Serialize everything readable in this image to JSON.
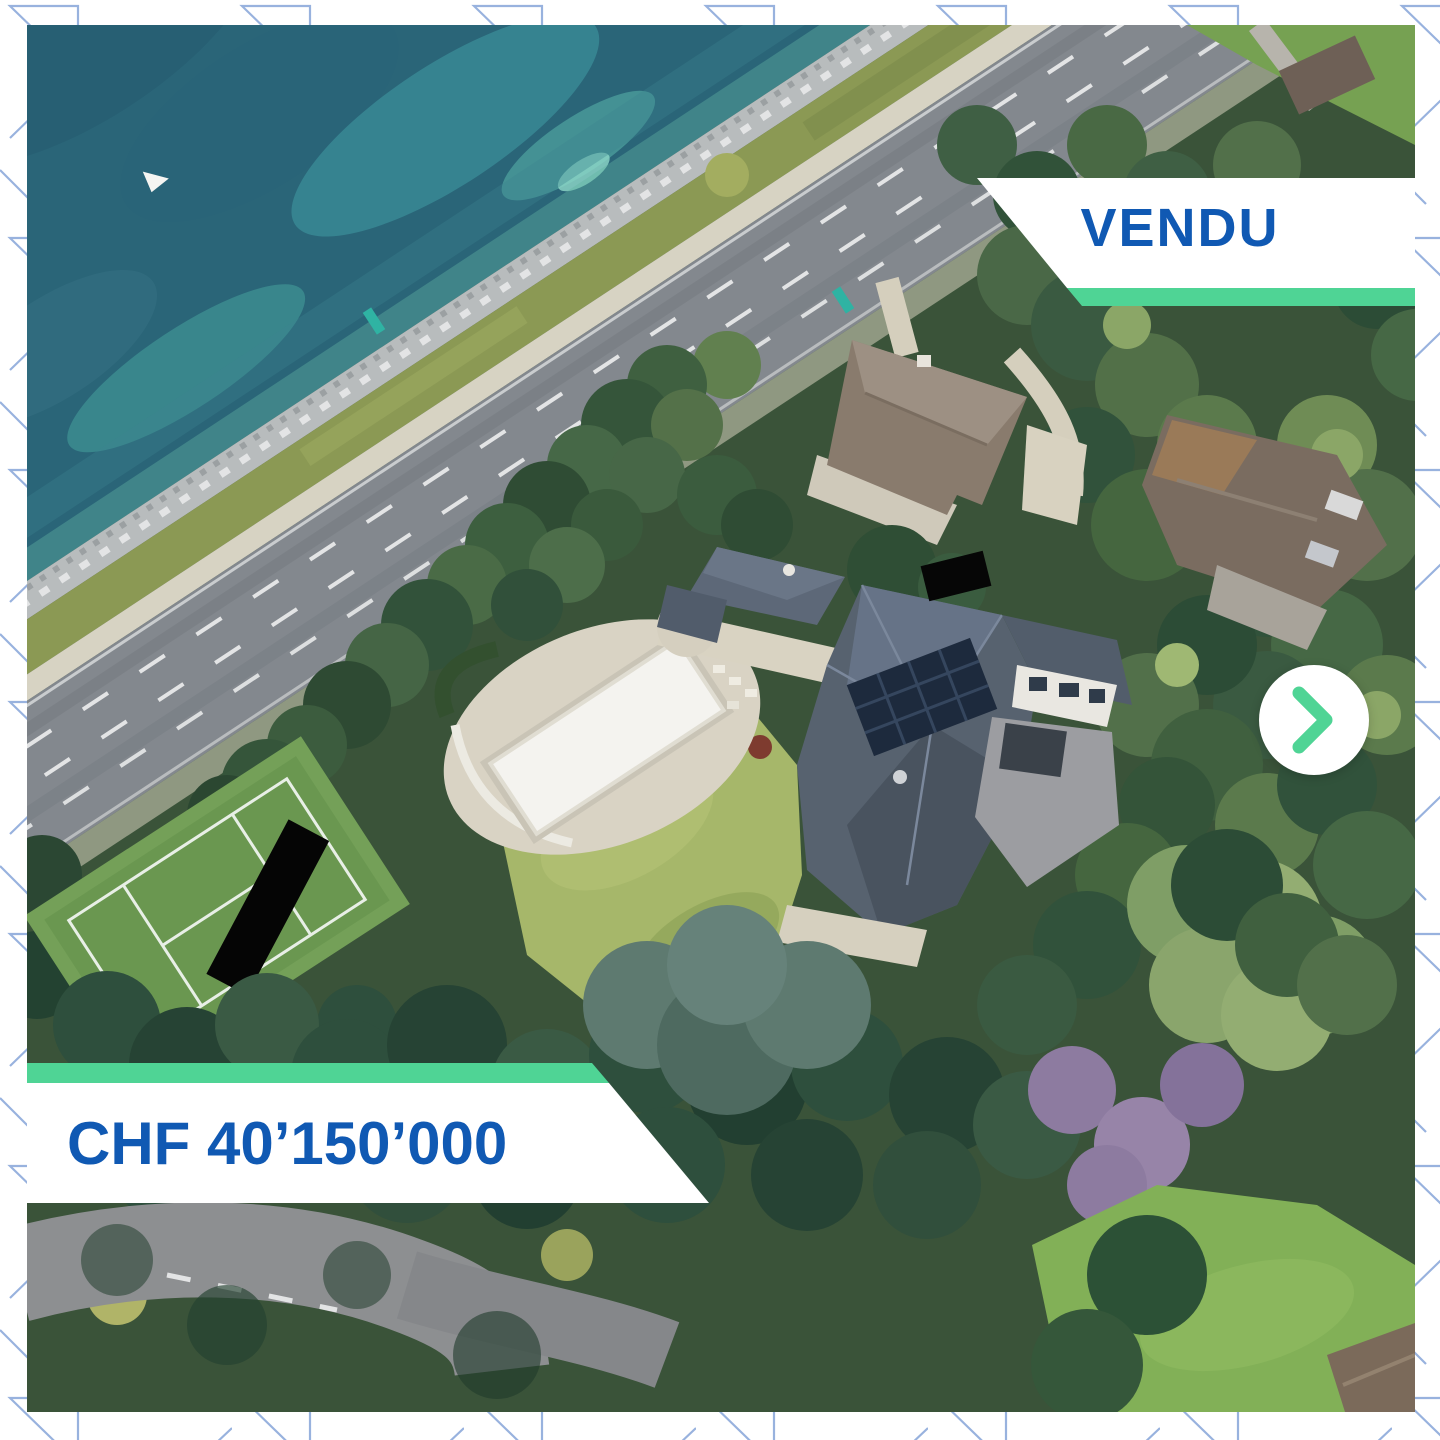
{
  "carousel": {
    "status_banner": {
      "label": "VENDU"
    },
    "price_banner": {
      "label": "CHF 40’150’000"
    },
    "next_button": {
      "icon": "chevron-right"
    }
  },
  "photo": {
    "description": "3D aerial view of a lakefront estate: turquoise lake and stone promenade, lakeside road with lane markings, large mansion with dark hipped roof and solar panels, covered white pool on a terrace, lawn, tennis court, neighboring houses and dense trees"
  },
  "colors": {
    "text_blue": "#1059b3",
    "accent_green": "#4fd495",
    "pattern_blue": "#86a4d8",
    "frame_white": "#ffffff"
  }
}
